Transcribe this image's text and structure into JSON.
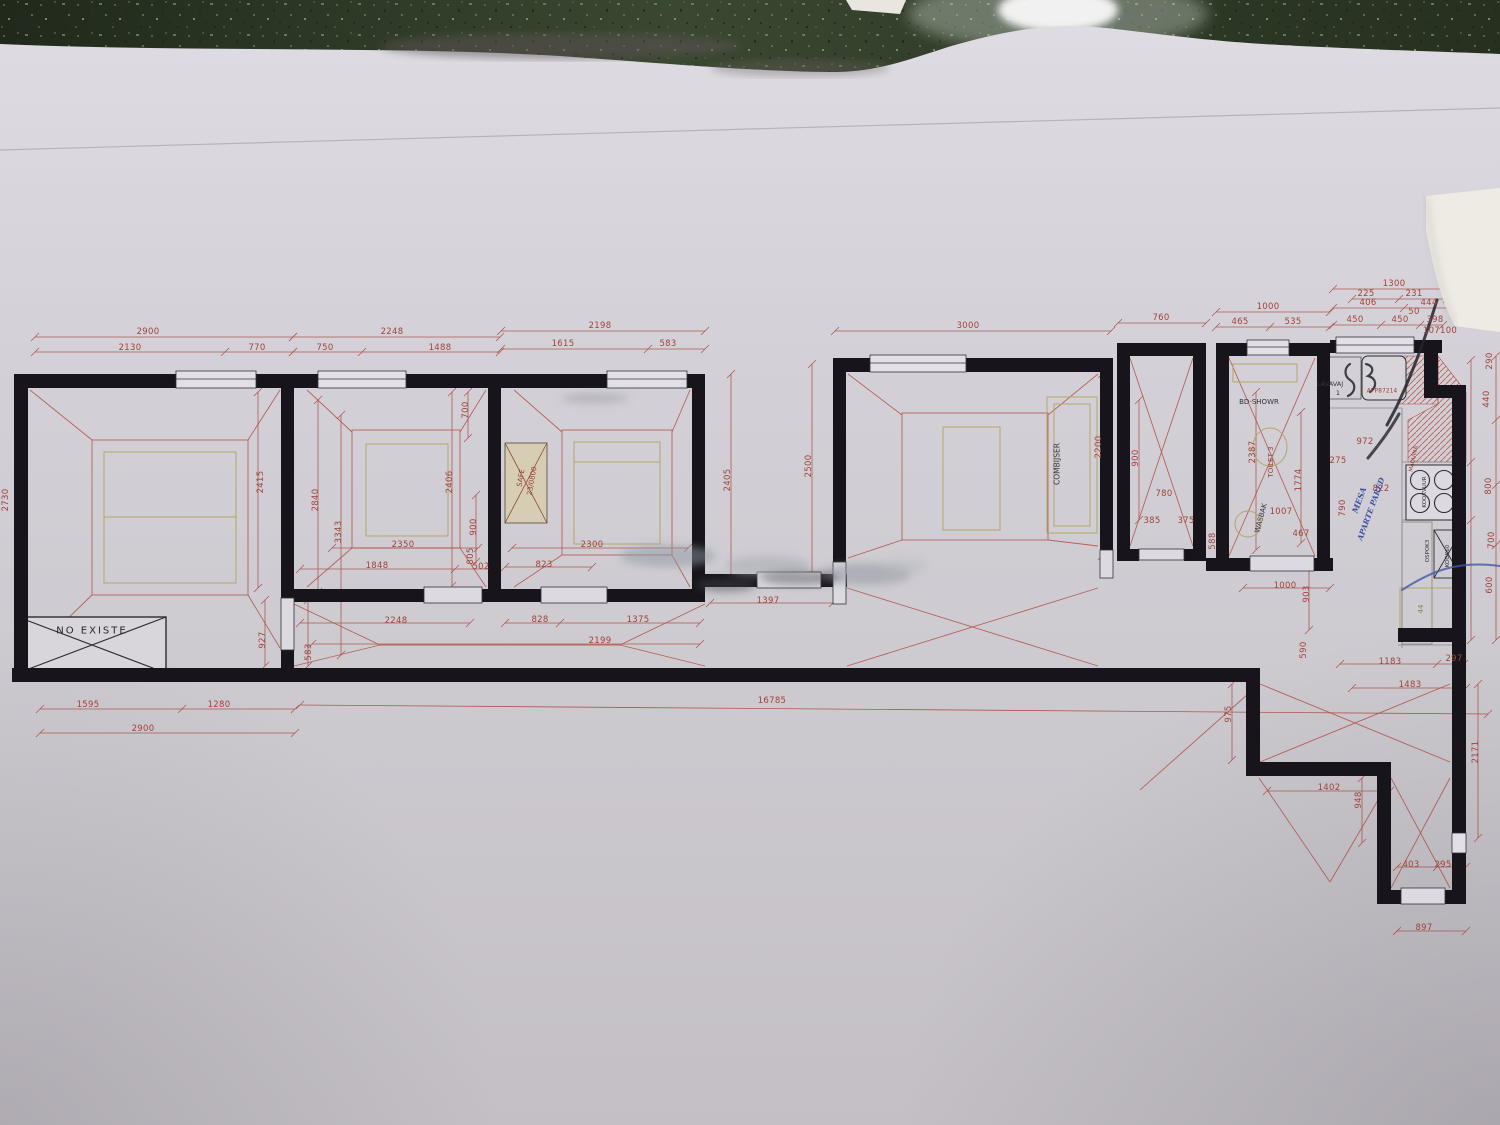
{
  "scene": "photo of architectural floor plan on table",
  "colors": {
    "dim_text": "#a2423a",
    "wall": "#17151b",
    "envelope_red": "#b0483e",
    "furniture_yellow": "#b3a76b",
    "pen_blue": "#4256a8",
    "pen_black": "#23232b",
    "paper": "#d2d0d6",
    "table": "#333d2a",
    "torn_patch": "#edebe4"
  },
  "annotations": [
    {
      "t": "NO EXISTE",
      "x": 92,
      "y": 631,
      "r": 0,
      "c": "#26262e",
      "s": 10,
      "ls": 2
    },
    {
      "t": "SAFE",
      "x": 521,
      "y": 478,
      "r": -80,
      "c": "#9a4038",
      "s": 7
    },
    {
      "t": "23/0800",
      "x": 532,
      "y": 481,
      "r": -80,
      "c": "#9a4038",
      "s": 7
    },
    {
      "t": "COMBIJSER",
      "x": 1057,
      "y": 464,
      "r": -90,
      "c": "#33333b",
      "s": 7.5
    },
    {
      "t": "BD-SHOWR",
      "x": 1259,
      "y": 402,
      "r": 0,
      "c": "#33333b",
      "s": 7
    },
    {
      "t": "TOILET 3",
      "x": 1271,
      "y": 462,
      "r": -90,
      "c": "#9a4038",
      "s": 7
    },
    {
      "t": "WASBAK",
      "x": 1261,
      "y": 518,
      "r": -75,
      "c": "#33333b",
      "s": 7
    },
    {
      "t": "LAVAVAJ",
      "x": 1330,
      "y": 384,
      "r": 0,
      "c": "#33333b",
      "s": 6.5
    },
    {
      "t": "1",
      "x": 1338,
      "y": 393,
      "r": 0,
      "c": "#33333b",
      "s": 6.5
    },
    {
      "t": "APP87214",
      "x": 1382,
      "y": 391,
      "r": 0,
      "c": "#9a4038",
      "s": 6
    },
    {
      "t": "MAQUINA",
      "x": 1414,
      "y": 459,
      "r": -78,
      "c": "#9a4038",
      "s": 5.5
    },
    {
      "t": "KOOKVUUR",
      "x": 1425,
      "y": 492,
      "r": -90,
      "c": "#33333b",
      "s": 5.5
    },
    {
      "t": "OSPOK3",
      "x": 1428,
      "y": 551,
      "r": -90,
      "c": "#33333b",
      "s": 5.5
    },
    {
      "t": "KOOK60",
      "x": 1448,
      "y": 556,
      "r": -90,
      "c": "#33333b",
      "s": 5.5
    },
    {
      "t": "44",
      "x": 1421,
      "y": 609,
      "r": -90,
      "c": "#8d8050",
      "s": 7
    },
    {
      "t": "MESA",
      "x": 1359,
      "y": 500,
      "r": -70,
      "c": "#3d51a3",
      "s": 8,
      "hw": true
    },
    {
      "t": "APARTE PARED",
      "x": 1371,
      "y": 509,
      "r": -70,
      "c": "#3d51a3",
      "s": 7.5,
      "hw": true
    }
  ],
  "dim_labels": [
    {
      "t": "2900",
      "x": 148,
      "y": 332
    },
    {
      "t": "2130",
      "x": 130,
      "y": 348
    },
    {
      "t": "770",
      "x": 257,
      "y": 348
    },
    {
      "t": "2248",
      "x": 392,
      "y": 332
    },
    {
      "t": "750",
      "x": 325,
      "y": 348
    },
    {
      "t": "1488",
      "x": 440,
      "y": 348
    },
    {
      "t": "2198",
      "x": 600,
      "y": 326
    },
    {
      "t": "1615",
      "x": 563,
      "y": 344
    },
    {
      "t": "583",
      "x": 668,
      "y": 344
    },
    {
      "t": "3000",
      "x": 968,
      "y": 326
    },
    {
      "t": "760",
      "x": 1161,
      "y": 318
    },
    {
      "t": "1000",
      "x": 1268,
      "y": 307
    },
    {
      "t": "465",
      "x": 1240,
      "y": 322
    },
    {
      "t": "535",
      "x": 1293,
      "y": 322
    },
    {
      "t": "1300",
      "x": 1394,
      "y": 284
    },
    {
      "t": "225",
      "x": 1366,
      "y": 294
    },
    {
      "t": "231",
      "x": 1414,
      "y": 294
    },
    {
      "t": "406",
      "x": 1368,
      "y": 303
    },
    {
      "t": "444",
      "x": 1429,
      "y": 303
    },
    {
      "t": "450",
      "x": 1355,
      "y": 320
    },
    {
      "t": "450",
      "x": 1400,
      "y": 320
    },
    {
      "t": "50",
      "x": 1414,
      "y": 312
    },
    {
      "t": "398",
      "x": 1435,
      "y": 320
    },
    {
      "t": "107100",
      "x": 1440,
      "y": 331
    },
    {
      "t": "2415",
      "x": 261,
      "y": 482,
      "r": -90
    },
    {
      "t": "2840",
      "x": 316,
      "y": 500,
      "r": -90
    },
    {
      "t": "3343",
      "x": 339,
      "y": 532,
      "r": -90
    },
    {
      "t": "2406",
      "x": 450,
      "y": 482,
      "r": -90
    },
    {
      "t": "900",
      "x": 474,
      "y": 527,
      "r": -90
    },
    {
      "t": "700",
      "x": 466,
      "y": 410,
      "r": -90
    },
    {
      "t": "805",
      "x": 471,
      "y": 556,
      "r": -90
    },
    {
      "t": "502",
      "x": 481,
      "y": 567
    },
    {
      "t": "2350",
      "x": 403,
      "y": 545
    },
    {
      "t": "1848",
      "x": 377,
      "y": 566
    },
    {
      "t": "2300",
      "x": 592,
      "y": 545
    },
    {
      "t": "823",
      "x": 544,
      "y": 565
    },
    {
      "t": "828",
      "x": 540,
      "y": 620
    },
    {
      "t": "1375",
      "x": 638,
      "y": 620
    },
    {
      "t": "2248",
      "x": 396,
      "y": 621
    },
    {
      "t": "2199",
      "x": 600,
      "y": 641
    },
    {
      "t": "1397",
      "x": 768,
      "y": 601
    },
    {
      "t": "927",
      "x": 263,
      "y": 640,
      "r": -90
    },
    {
      "t": "583",
      "x": 309,
      "y": 652,
      "r": -90
    },
    {
      "t": "2405",
      "x": 728,
      "y": 480,
      "r": -90
    },
    {
      "t": "2500",
      "x": 809,
      "y": 466,
      "r": -90
    },
    {
      "t": "2200",
      "x": 1099,
      "y": 447,
      "r": -90
    },
    {
      "t": "900",
      "x": 1136,
      "y": 458,
      "r": -90
    },
    {
      "t": "780",
      "x": 1164,
      "y": 494
    },
    {
      "t": "385",
      "x": 1152,
      "y": 521
    },
    {
      "t": "375",
      "x": 1186,
      "y": 521
    },
    {
      "t": "588",
      "x": 1213,
      "y": 541,
      "r": -90
    },
    {
      "t": "2387",
      "x": 1253,
      "y": 452,
      "r": -90
    },
    {
      "t": "1774",
      "x": 1299,
      "y": 480,
      "r": -90
    },
    {
      "t": "1007",
      "x": 1281,
      "y": 512
    },
    {
      "t": "467",
      "x": 1301,
      "y": 534
    },
    {
      "t": "275",
      "x": 1338,
      "y": 461
    },
    {
      "t": "972",
      "x": 1365,
      "y": 442
    },
    {
      "t": "822",
      "x": 1381,
      "y": 489
    },
    {
      "t": "790",
      "x": 1343,
      "y": 508,
      "r": -90
    },
    {
      "t": "1595",
      "x": 88,
      "y": 705
    },
    {
      "t": "1280",
      "x": 219,
      "y": 705
    },
    {
      "t": "2900",
      "x": 143,
      "y": 729
    },
    {
      "t": "16785",
      "x": 772,
      "y": 701
    },
    {
      "t": "1000",
      "x": 1285,
      "y": 586
    },
    {
      "t": "903",
      "x": 1307,
      "y": 594,
      "r": -90
    },
    {
      "t": "590",
      "x": 1304,
      "y": 650,
      "r": -90
    },
    {
      "t": "1183",
      "x": 1390,
      "y": 662
    },
    {
      "t": "297",
      "x": 1454,
      "y": 659
    },
    {
      "t": "1483",
      "x": 1410,
      "y": 685
    },
    {
      "t": "1402",
      "x": 1329,
      "y": 788
    },
    {
      "t": "948",
      "x": 1359,
      "y": 800,
      "r": -90
    },
    {
      "t": "975",
      "x": 1229,
      "y": 714,
      "r": -90
    },
    {
      "t": "2171",
      "x": 1476,
      "y": 752,
      "r": -90
    },
    {
      "t": "403",
      "x": 1411,
      "y": 865
    },
    {
      "t": "295",
      "x": 1443,
      "y": 865
    },
    {
      "t": "897",
      "x": 1424,
      "y": 928
    },
    {
      "t": "2730",
      "x": 6,
      "y": 500,
      "r": -90
    },
    {
      "t": "290",
      "x": 1490,
      "y": 361,
      "r": -90
    },
    {
      "t": "440",
      "x": 1487,
      "y": 399,
      "r": -90
    },
    {
      "t": "800",
      "x": 1489,
      "y": 486,
      "r": -90
    },
    {
      "t": "700",
      "x": 1492,
      "y": 540,
      "r": -90
    },
    {
      "t": "600",
      "x": 1490,
      "y": 585,
      "r": -90
    }
  ]
}
